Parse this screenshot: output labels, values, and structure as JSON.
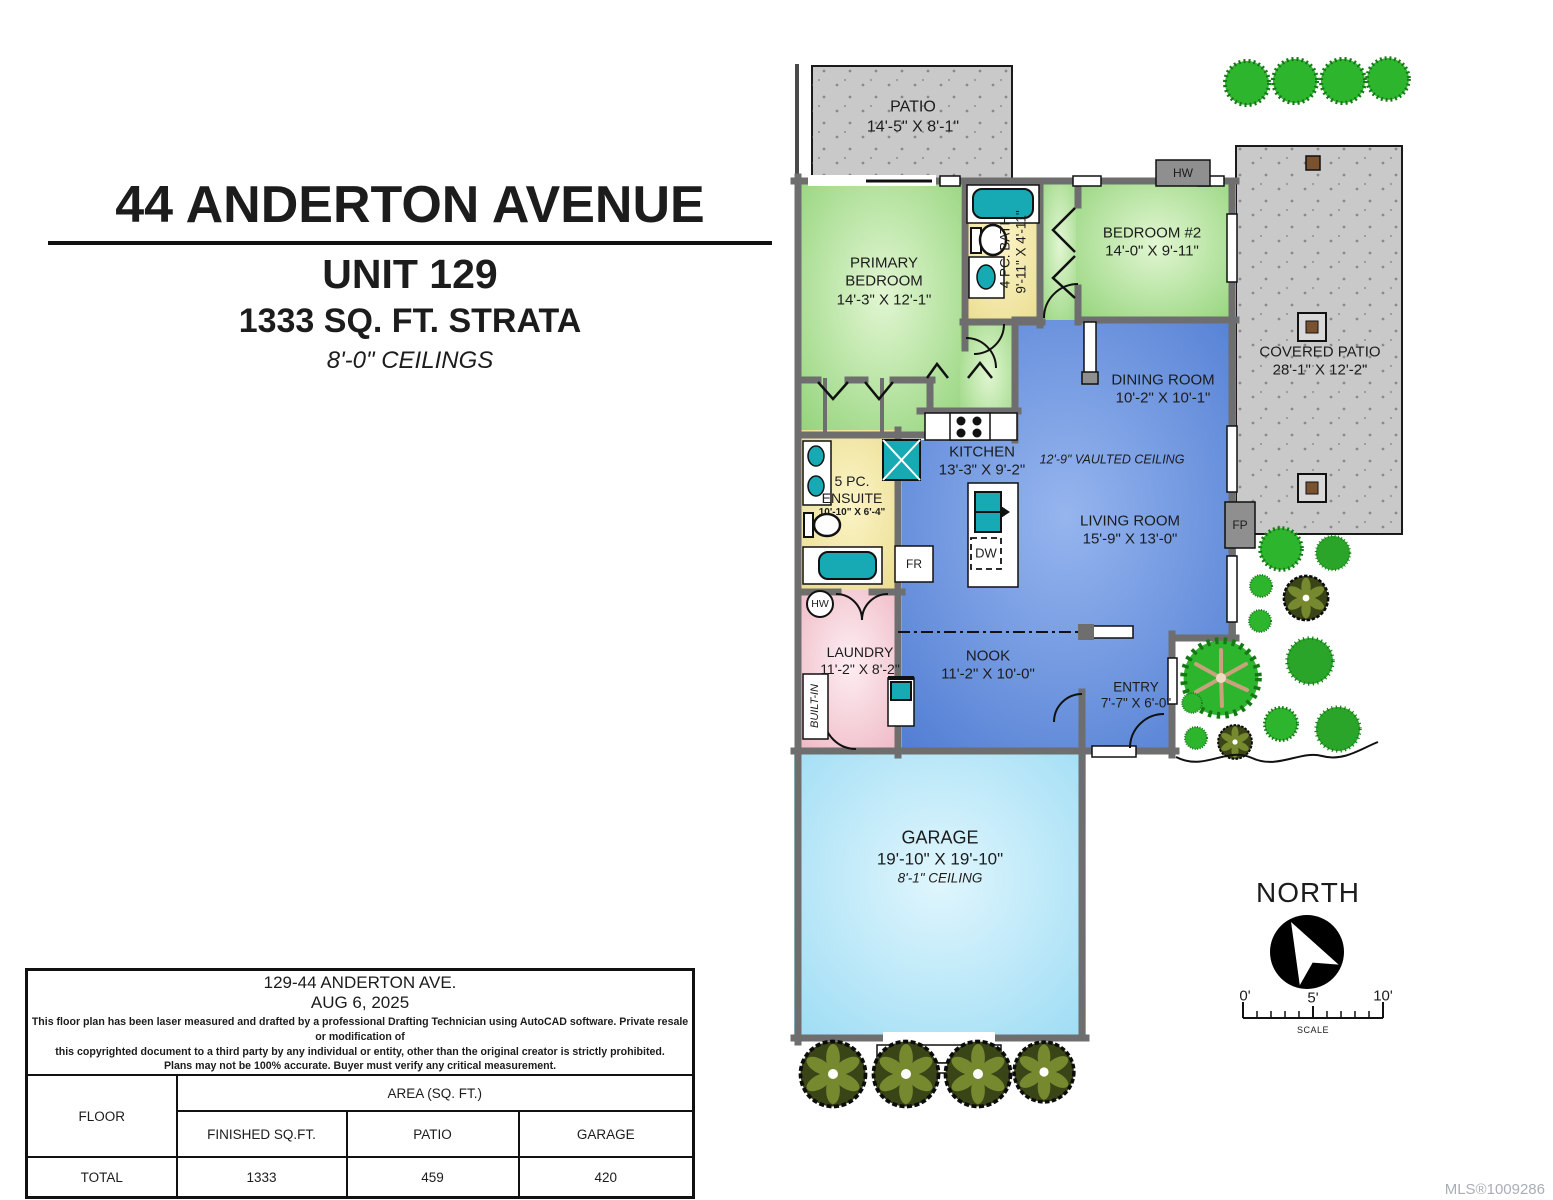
{
  "title": {
    "address": "44 ANDERTON AVENUE",
    "unit": "UNIT 129",
    "area": "1333 SQ. FT. STRATA",
    "ceilings": "8'-0\" CEILINGS"
  },
  "rooms": {
    "patio": {
      "name": "PATIO",
      "dims": "14'-5\" X 8'-1\""
    },
    "primary_bedroom": {
      "name": "PRIMARY BEDROOM",
      "dims": "14'-3\" X 12'-1\""
    },
    "bath_4pc": {
      "name": "4 PC. BATH",
      "dims": "9'-11\" X 4'-11\""
    },
    "bedroom_2": {
      "name": "BEDROOM #2",
      "dims": "14'-0\" X 9'-11\""
    },
    "covered_patio": {
      "name": "COVERED PATIO",
      "dims": "28'-1\" X 12'-2\""
    },
    "dining_room": {
      "name": "DINING ROOM",
      "dims": "10'-2\" X 10'-1\""
    },
    "kitchen": {
      "name": "KITCHEN",
      "dims": "13'-3\" X 9'-2\""
    },
    "living_room": {
      "name": "LIVING ROOM",
      "dims": "15'-9\" X 13'-0\"",
      "note": "12'-9\" VAULTED CEILING"
    },
    "ensuite": {
      "name": "5 PC. ENSUITE",
      "dims": "10'-10\" X 6'-4\""
    },
    "laundry": {
      "name": "LAUNDRY",
      "dims": "11'-2\" X 8'-2\""
    },
    "nook": {
      "name": "NOOK",
      "dims": "11'-2\" X 10'-0\""
    },
    "entry": {
      "name": "ENTRY",
      "dims": "7'-7\" X 6'-0\""
    },
    "garage": {
      "name": "GARAGE",
      "dims": "19'-10\" X 19'-10\"",
      "ceiling": "8'-1\" CEILING"
    }
  },
  "fixtures": {
    "hw_top": "HW",
    "hw_laundry": "HW",
    "fridge": "FR",
    "dishwasher": "DW",
    "fireplace": "FP",
    "built_in": "BUILT-IN"
  },
  "compass": {
    "label": "NORTH"
  },
  "scale_bar": {
    "zero": "0'",
    "five": "5'",
    "ten": "10'",
    "label": "SCALE"
  },
  "info_table": {
    "address": "129-44 ANDERTON AVE.",
    "date": "AUG 6, 2025",
    "disclaimer_line1": "This floor plan has been laser measured and drafted by a professional Drafting Technician using AutoCAD software. Private resale or modification of",
    "disclaimer_line2": "this copyrighted document to a third party by any individual or entity, other than the original creator is strictly prohibited.",
    "disclaimer_line3": "Plans may not be 100% accurate.  Buyer must verify any critical measurement.",
    "header_floor": "FLOOR",
    "header_area": "AREA (SQ. FT.)",
    "header_finished": "FINISHED SQ.FT.",
    "header_patio": "PATIO",
    "header_garage": "GARAGE",
    "total_label": "TOTAL",
    "total_finished": "1333",
    "total_patio": "459",
    "total_garage": "420"
  },
  "mls": "MLS®1009286",
  "colors": {
    "bedroom_green": "#9ed887",
    "living_blue": "#5d8cdd",
    "bath_yellow": "#f2e7a2",
    "laundry_pink": "#f2c3cf",
    "garage_blue": "#aee3f8",
    "patio_gray": "#c9c9c9",
    "wall_gray": "#6e6e6e",
    "fixture_teal": "#17a9b4",
    "shrub_green": "#2eb52e"
  }
}
